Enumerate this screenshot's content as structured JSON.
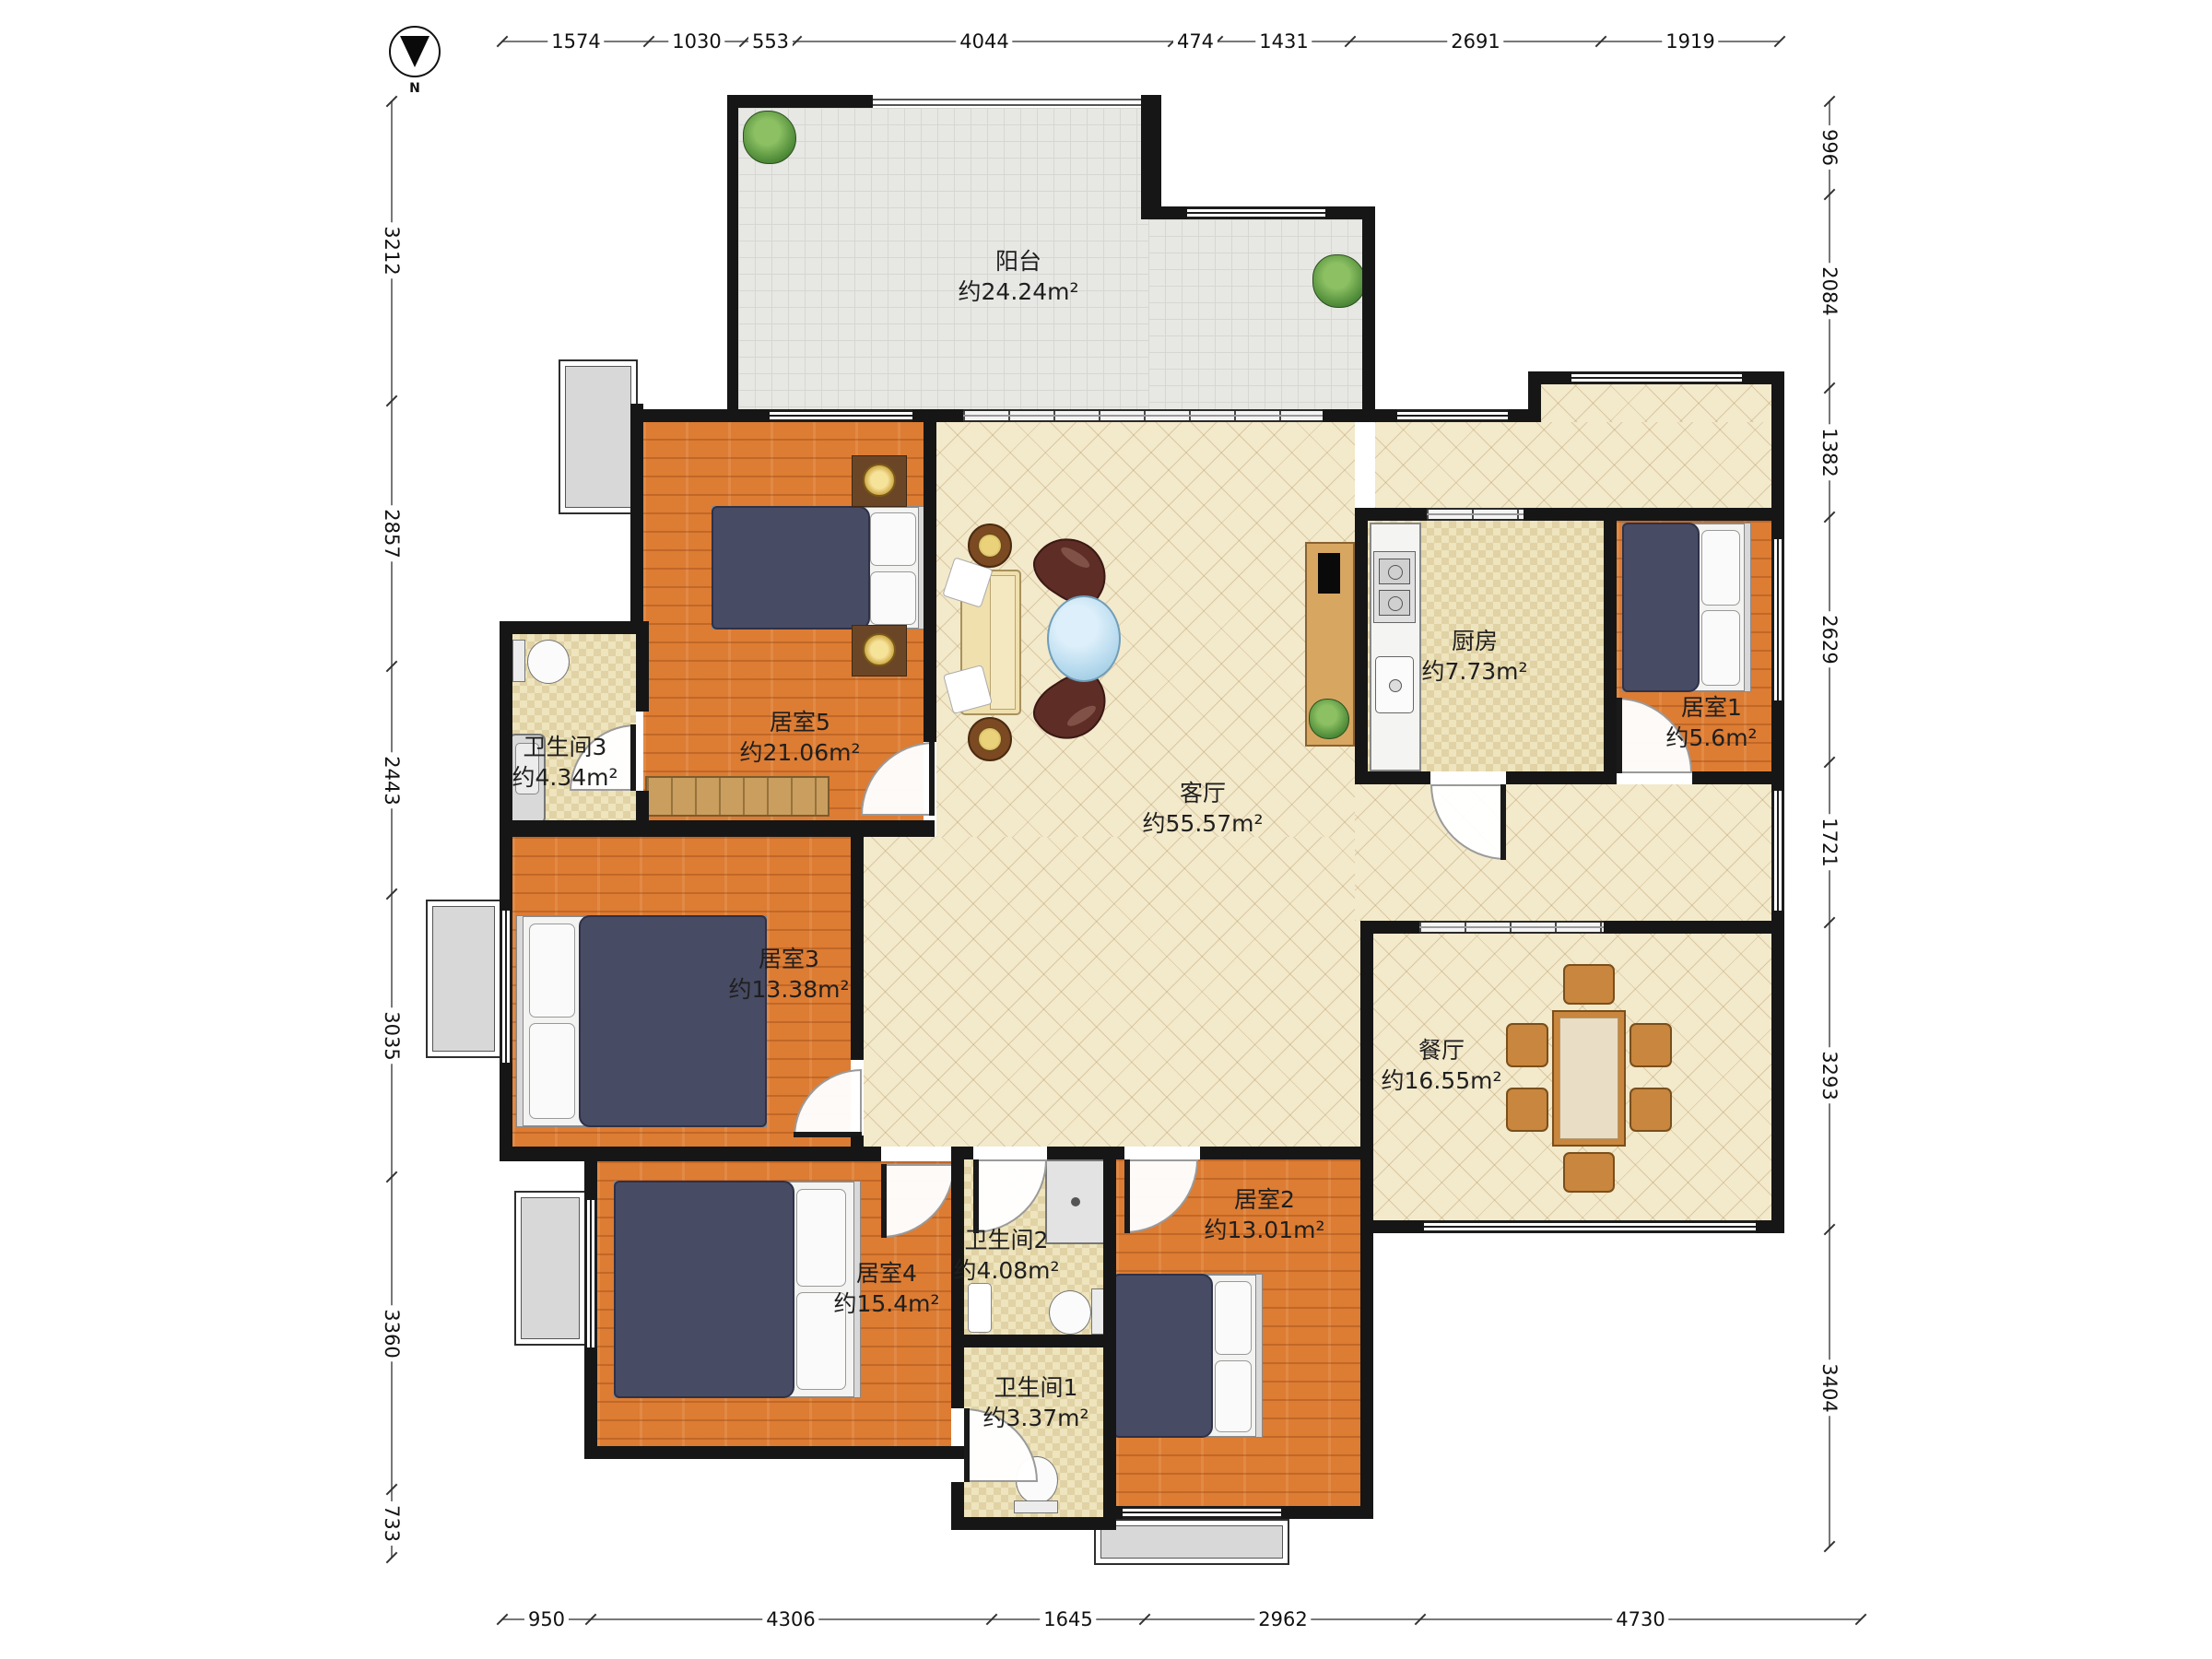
{
  "compass": {
    "label": "N"
  },
  "rooms": {
    "balcony": {
      "name": "阳台",
      "area": "约24.24m²"
    },
    "living": {
      "name": "客厅",
      "area": "约55.57m²"
    },
    "dining": {
      "name": "餐厅",
      "area": "约16.55m²"
    },
    "kitchen": {
      "name": "厨房",
      "area": "约7.73m²"
    },
    "bedroom1": {
      "name": "居室1",
      "area": "约5.6m²"
    },
    "bedroom2": {
      "name": "居室2",
      "area": "约13.01m²"
    },
    "bedroom3": {
      "name": "居室3",
      "area": "约13.38m²"
    },
    "bedroom4": {
      "name": "居室4",
      "area": "约15.4m²"
    },
    "bedroom5": {
      "name": "居室5",
      "area": "约21.06m²"
    },
    "bathroom1": {
      "name": "卫生间1",
      "area": "约3.37m²"
    },
    "bathroom2": {
      "name": "卫生间2",
      "area": "约4.08m²"
    },
    "bathroom3": {
      "name": "卫生间3",
      "area": "约4.34m²"
    }
  },
  "dimensions": {
    "top": [
      "1574",
      "1030",
      "553",
      "4044",
      "474",
      "1431",
      "2691",
      "1919"
    ],
    "bottom": [
      "950",
      "4306",
      "1645",
      "2962",
      "4730"
    ],
    "left": [
      "3212",
      "2857",
      "2443",
      "3035",
      "3360",
      "733"
    ],
    "right": [
      "996",
      "2084",
      "1382",
      "2629",
      "1721",
      "3293",
      "3404"
    ]
  },
  "palette": {
    "wall": "#161616",
    "wood_floor": "#dd7c33",
    "tile_floor": "#eee4bd",
    "hall_floor": "#f3e9cb",
    "balcony_floor": "#e7e7e4",
    "bed": "#474b63",
    "furniture_wood": "#c8863e",
    "coffee_table": "#b5d9ed",
    "plant": "#4e8a38",
    "platform": "#d8d8d8"
  }
}
